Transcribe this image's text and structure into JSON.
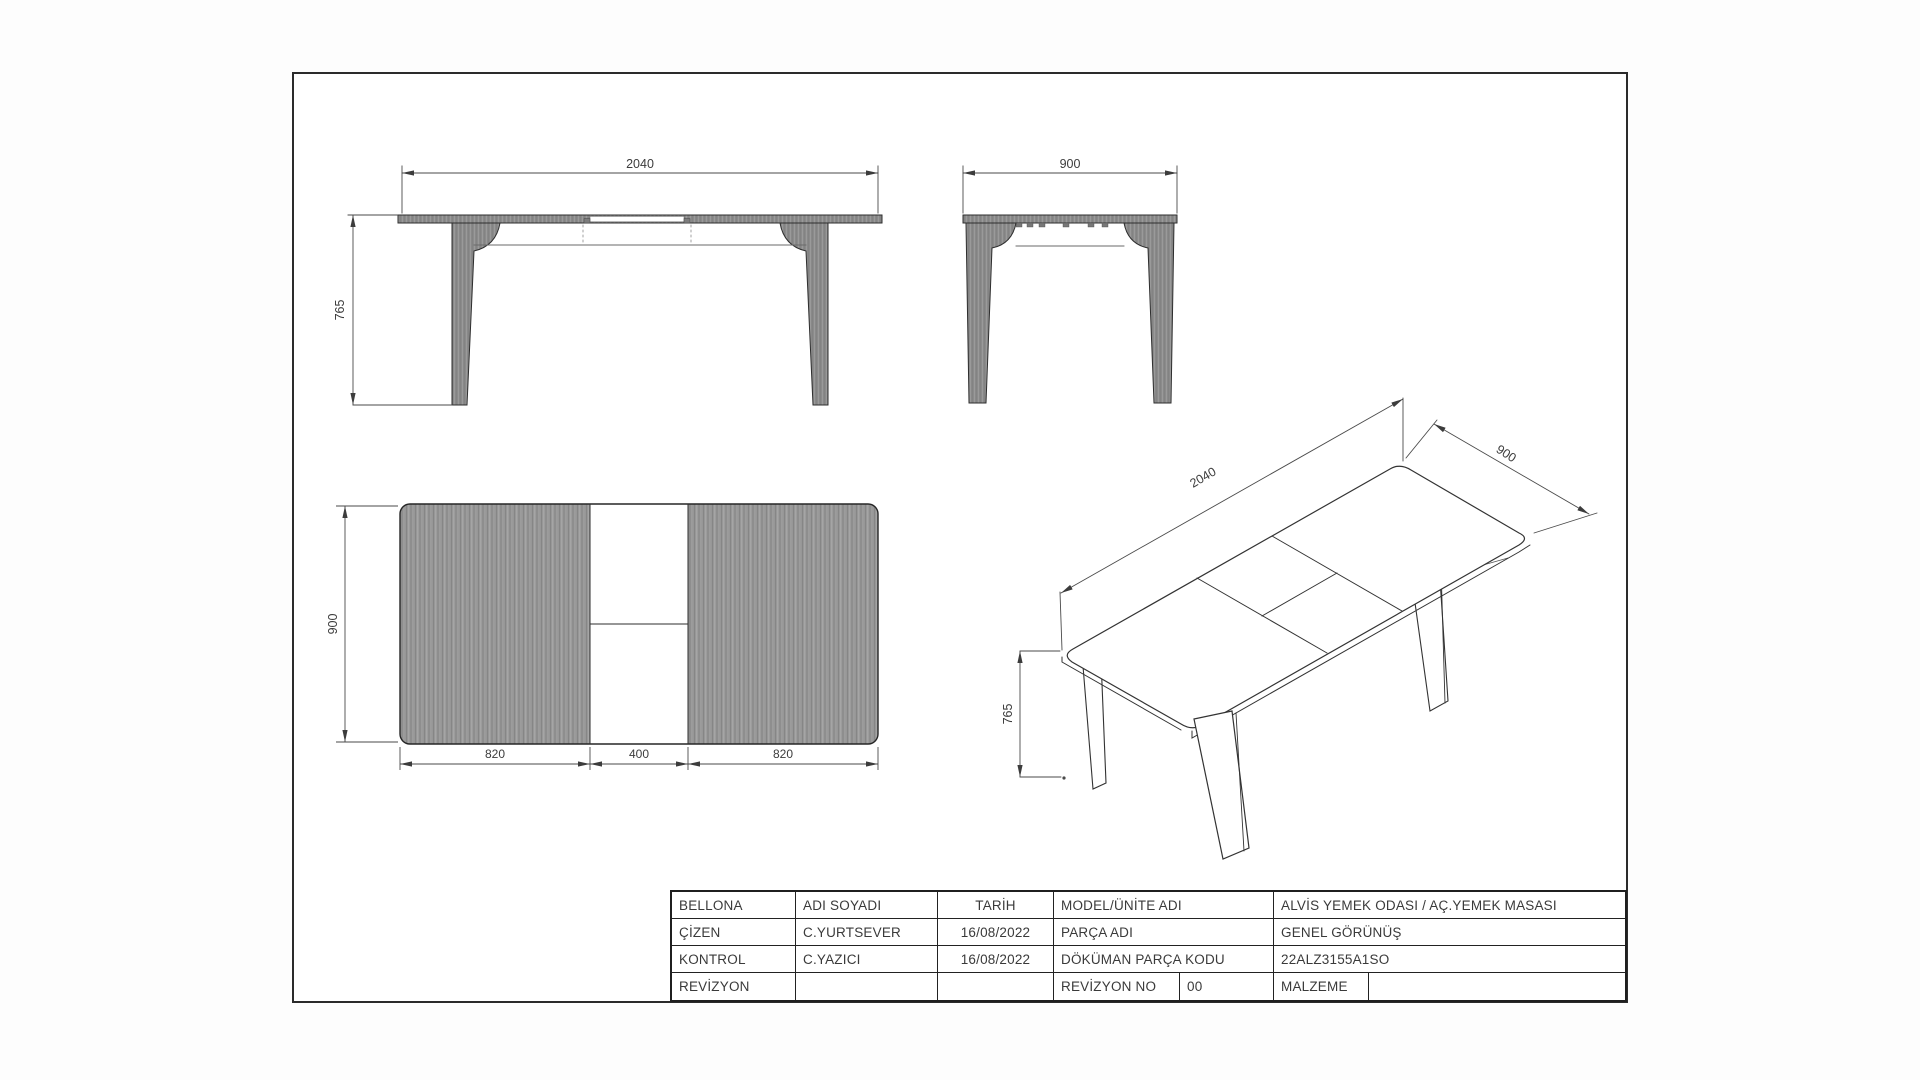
{
  "drawing": {
    "dims": {
      "front_width": "2040",
      "front_height": "765",
      "side_width": "900",
      "plan_depth": "900",
      "plan_seg_left": "820",
      "plan_seg_mid": "400",
      "plan_seg_right": "820",
      "iso_length": "2040",
      "iso_depth": "900",
      "iso_height": "765"
    },
    "colors": {
      "line": "#2e2e2e",
      "dimension_line": "#4a4a4a",
      "wood_fill": "#969696",
      "background": "#ffffff"
    }
  },
  "title_block": {
    "r1c1": "BELLONA",
    "r1c2": "ADI SOYADI",
    "r1c3": "TARİH",
    "r1c4": "MODEL/ÜNİTE ADI",
    "r1c5": "ALVİS YEMEK ODASI / AÇ.YEMEK MASASI",
    "r2c1": "ÇİZEN",
    "r2c2": "C.YURTSEVER",
    "r2c3": "16/08/2022",
    "r2c4": "PARÇA ADI",
    "r2c5": "GENEL GÖRÜNÜŞ",
    "r3c1": "KONTROL",
    "r3c2": "C.YAZICI",
    "r3c3": "16/08/2022",
    "r3c4": "DÖKÜMAN PARÇA KODU",
    "r3c5": "22ALZ3155A1SO",
    "r4c1": "REVİZYON",
    "r4c2": "",
    "r4c3": "",
    "r4c4": "REVİZYON NO",
    "r4c5": "00",
    "r4c6": "MALZEME",
    "r4c7": ""
  }
}
